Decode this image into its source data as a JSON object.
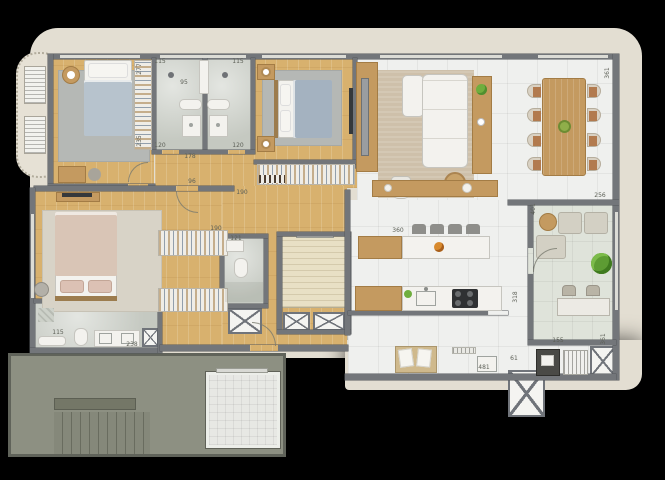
{
  "plan": {
    "type": "apartment-floor-plan-render",
    "background": "#000000",
    "palette": {
      "slab_cream": "#e3ded2",
      "wall_gray": "#73767a",
      "wood_floor": "#d8b16e",
      "marble_floor": "#cdd1c9",
      "tile_floor": "#eff0ee",
      "terrace_floor": "#dfe3da",
      "common_hall_gray": "#8d9082",
      "rug_beige": "#cec0aa",
      "rug_gray": "#b5b8b5",
      "bed_blue": "#a4b2c0",
      "bed_pink": "#d9c5b6",
      "plant_green": "#5d9c33",
      "cooktop_black": "#2f3133"
    }
  },
  "labels": [
    {
      "text": "277"
    },
    {
      "text": "115"
    },
    {
      "text": "115"
    },
    {
      "text": "95"
    },
    {
      "text": "235"
    },
    {
      "text": "120"
    },
    {
      "text": "120"
    },
    {
      "text": "178"
    },
    {
      "text": "96"
    },
    {
      "text": "190"
    },
    {
      "text": "190"
    },
    {
      "text": "121"
    },
    {
      "text": "115"
    },
    {
      "text": "238"
    },
    {
      "text": "360"
    },
    {
      "text": "318"
    },
    {
      "text": "256"
    },
    {
      "text": "401"
    },
    {
      "text": "361"
    },
    {
      "text": "155"
    },
    {
      "text": "361"
    },
    {
      "text": "61"
    },
    {
      "text": "481"
    }
  ]
}
